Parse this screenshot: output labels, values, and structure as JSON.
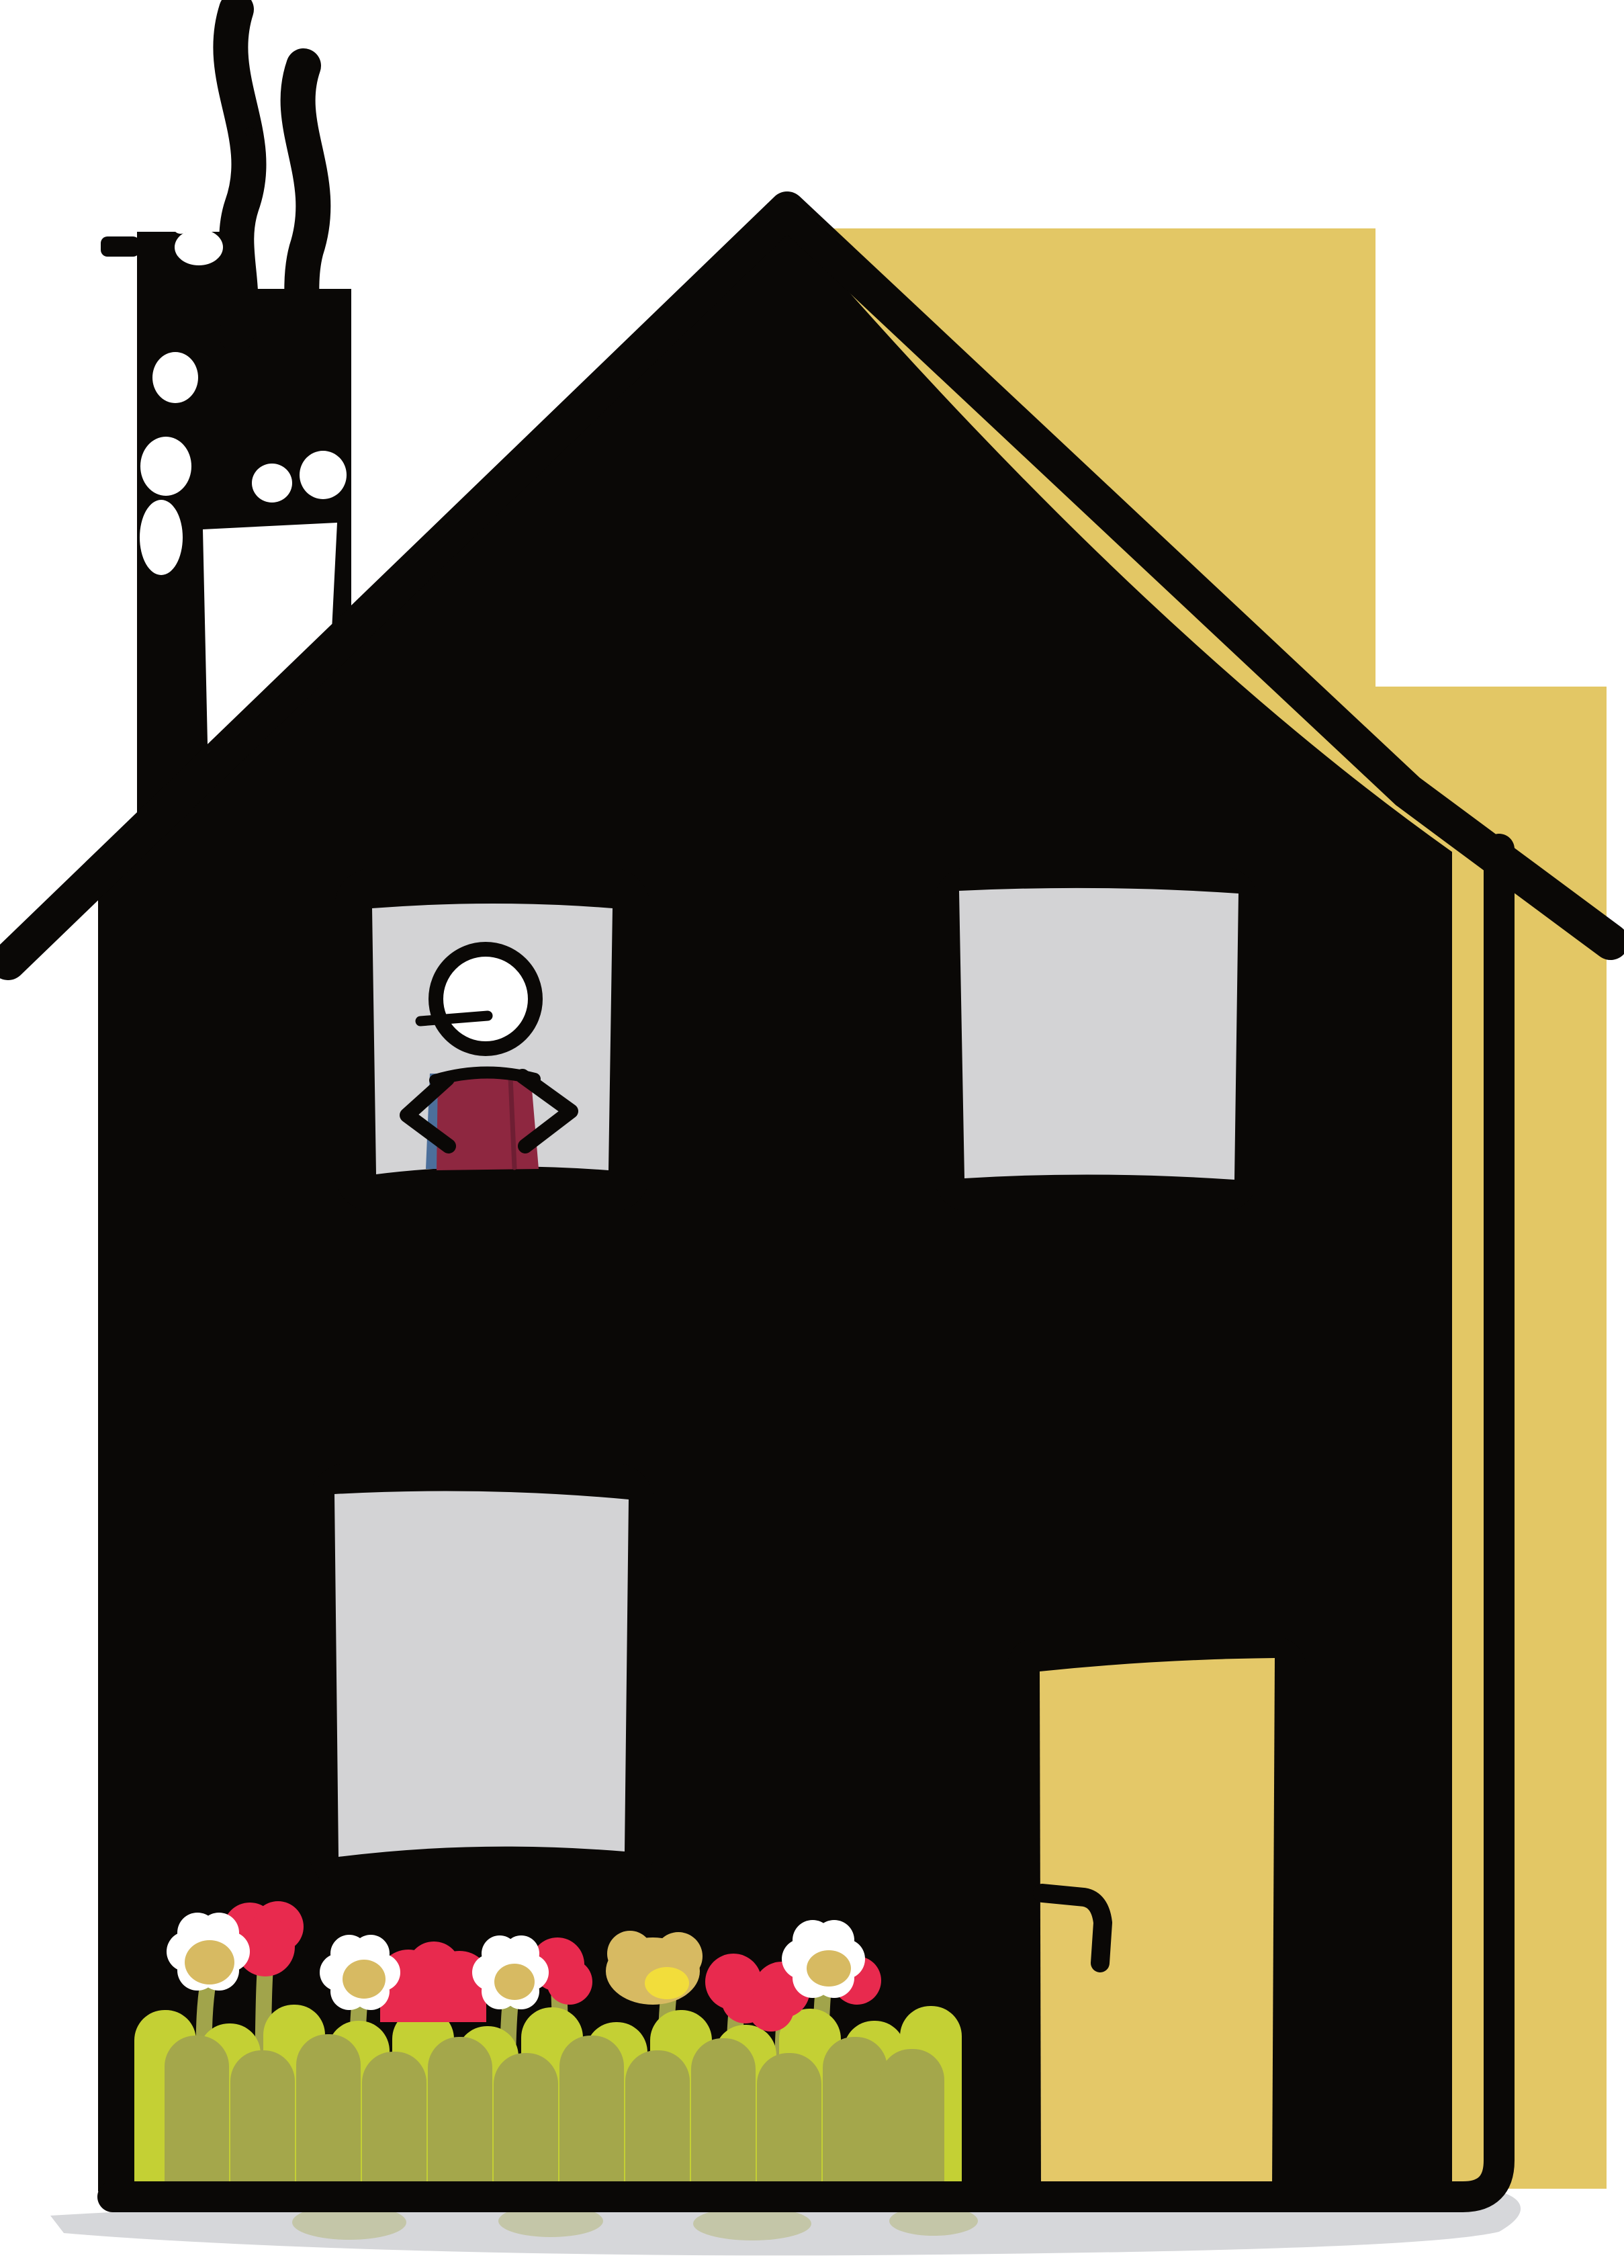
{
  "scene": {
    "type": "hand-drawn illustration",
    "subject": "tall black house with yellow backdrop panel",
    "house": {
      "body": "solid black, two storeys",
      "roof": "steep gable drawn as a long black stroke overhanging both sides",
      "outline_offset": "separate black outline stroke offset from right wall and bottom, yellow showing through the gap",
      "window_count": 3,
      "door": "yellow door at lower right with black jambs and hooked black handle"
    },
    "person": {
      "location": "upper-left window",
      "head": "white circle with black outline and small mouth line poking out left",
      "shirt": "maroon with a blue sliver on its left edge",
      "pose": "stick arms akimbo, hands on hips"
    },
    "chimney": {
      "position": "top left",
      "smoke_trails": 2,
      "decor": "white dots, blobs and a white slanted patch on the black chimney column"
    },
    "garden": {
      "daisies_white": 4,
      "red_flowers": 6,
      "golden_flower": 1,
      "stems": "olive green with heart-shaped leaf loops",
      "fence": "round-topped pickets in two greens along the house base"
    },
    "background": {
      "panel": "mustard stepped rectangle behind the right half of the house",
      "ground_shadow": "soft gray ribbon under the house with faint green reflections"
    }
  },
  "colors": {
    "paper": "#ffffff",
    "ink": "#0a0806",
    "backdrop_yellow": "#e3c765",
    "door_yellow": "#e4c868",
    "window_gray": "#d3d3d5",
    "shadow_gray": "#d6d7da",
    "shirt_maroon": "#8e2740",
    "shirt_fold": "#6e1e33",
    "shirt_blue": "#4c6f9b",
    "flower_red": "#e82a4e",
    "daisy_white": "#ffffff",
    "daisy_center_tan": "#d7ba62",
    "daisy_center_yellow": "#f2dd3b",
    "stem_olive": "#a1a44b",
    "fence_bright": "#c4d034",
    "fence_olive": "#a4a74b"
  }
}
